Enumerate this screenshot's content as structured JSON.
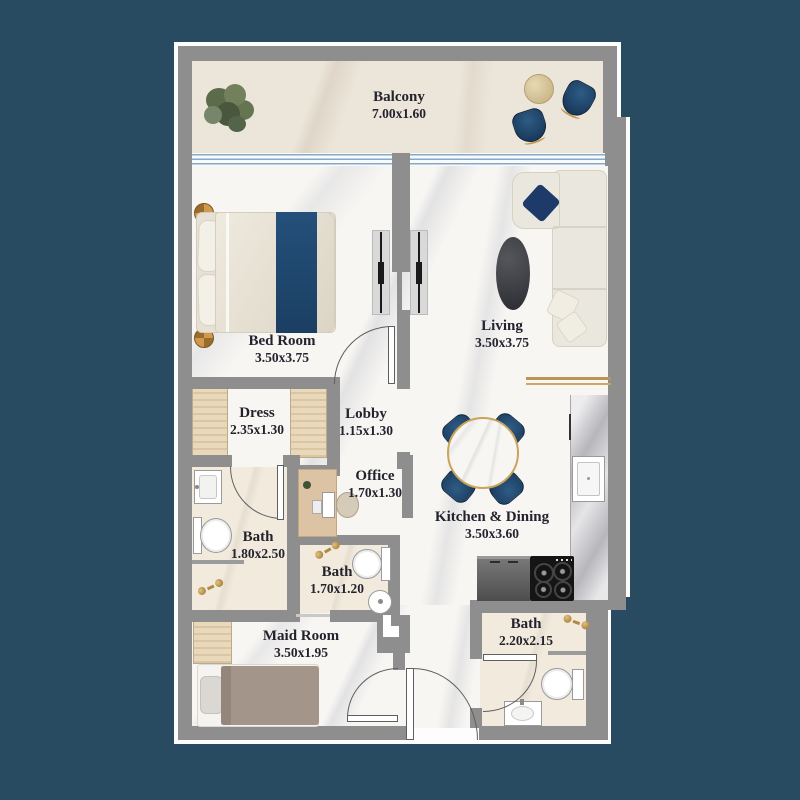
{
  "plan_title": "Apartment Floor Plan",
  "rooms": [
    {
      "id": "balcony",
      "name": "Balcony",
      "dims": "7.00x1.60"
    },
    {
      "id": "bedroom",
      "name": "Bed Room",
      "dims": "3.50x3.75"
    },
    {
      "id": "living",
      "name": "Living",
      "dims": "3.50x3.75"
    },
    {
      "id": "dress",
      "name": "Dress",
      "dims": "2.35x1.30"
    },
    {
      "id": "lobby",
      "name": "Lobby",
      "dims": "1.15x1.30"
    },
    {
      "id": "office",
      "name": "Office",
      "dims": "1.70x1.30"
    },
    {
      "id": "bath_master",
      "name": "Bath",
      "dims": "1.80x2.50"
    },
    {
      "id": "bath_inner",
      "name": "Bath",
      "dims": "1.70x1.20"
    },
    {
      "id": "kitchen_dining",
      "name": "Kitchen & Dining",
      "dims": "3.50x3.60"
    },
    {
      "id": "maid_room",
      "name": "Maid Room",
      "dims": "3.50x1.95"
    },
    {
      "id": "bath_guest",
      "name": "Bath",
      "dims": "2.20x2.15"
    }
  ],
  "colors": {
    "background": "#284b61",
    "wall": "#8e8e8e",
    "accent_navy": "#1d4067",
    "gold": "#c9a45a",
    "glass_blue": "#8fb3d4",
    "label_text": "#23232e"
  }
}
